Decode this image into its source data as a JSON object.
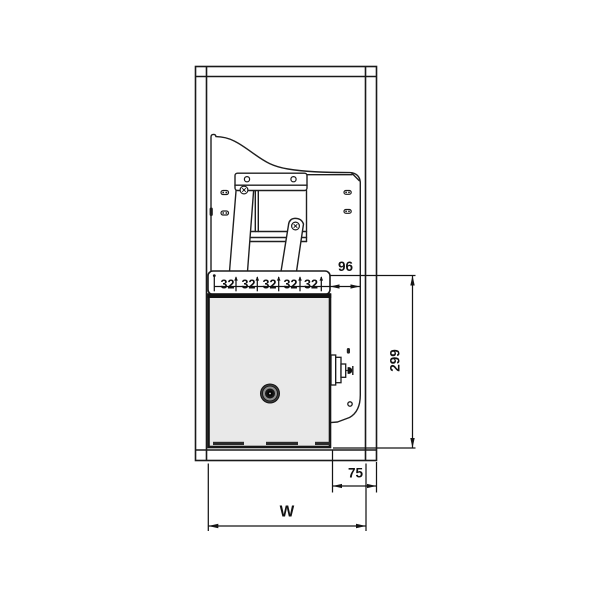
{
  "diagram": {
    "name": "cabinet-lift-mechanism-front-elevation",
    "colors": {
      "line": "#1a1a1a",
      "unit_fill": "#e9e9e9",
      "background": "#ffffff"
    },
    "dimensions": {
      "system_hole_spacings": [
        "32",
        "32",
        "32",
        "32",
        "32"
      ],
      "front_offset": "96",
      "unit_height": "299",
      "side_clearance": "75",
      "cabinet_width": "W"
    }
  }
}
